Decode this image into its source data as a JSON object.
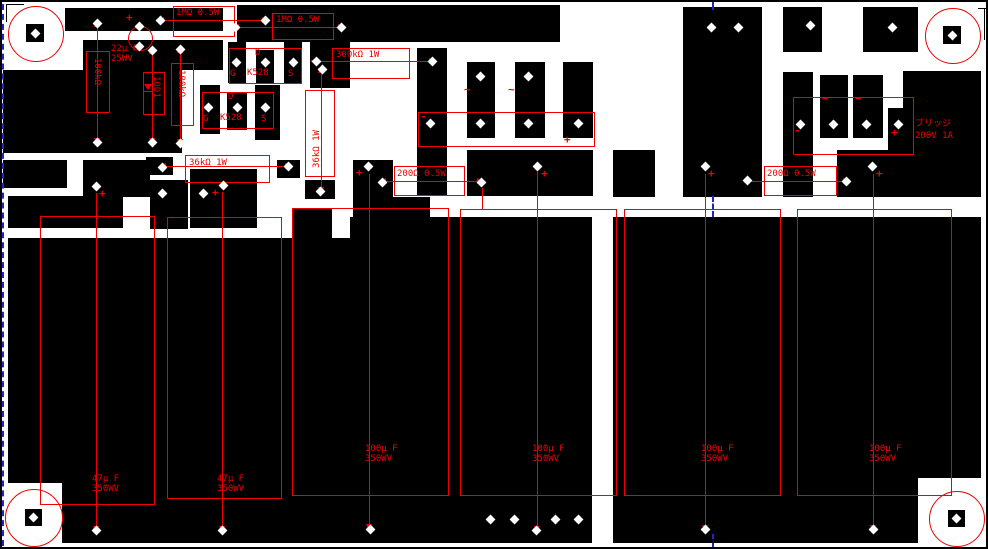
{
  "canvas": {
    "type": "pcb-layout",
    "board_color": "#ffffff",
    "copper_color": "#000000",
    "silkscreen_color": "#ee0000",
    "guide_color": "#2222cc"
  },
  "labels": {
    "r1m": "1MΩ 0.5W",
    "r300k": "300kΩ 1W",
    "r36k": "36kΩ 1W",
    "r200": "200Ω 0.5W",
    "r100k": "100kΩ",
    "d10d1": "10D1",
    "c22_value": "22μ F",
    "c22_voltage": "25WV",
    "c47_value": "47μ F",
    "c47_voltage": "350WV",
    "c100_value": "100μ F",
    "c100_voltage": "350WV",
    "q_d": "D",
    "q_g": "G",
    "q_s": "S",
    "q_part": "K528",
    "bridge_name": "ブリッジ",
    "bridge_rating": "200V 1A",
    "plus": "+",
    "minus": "-",
    "ac": "~"
  }
}
